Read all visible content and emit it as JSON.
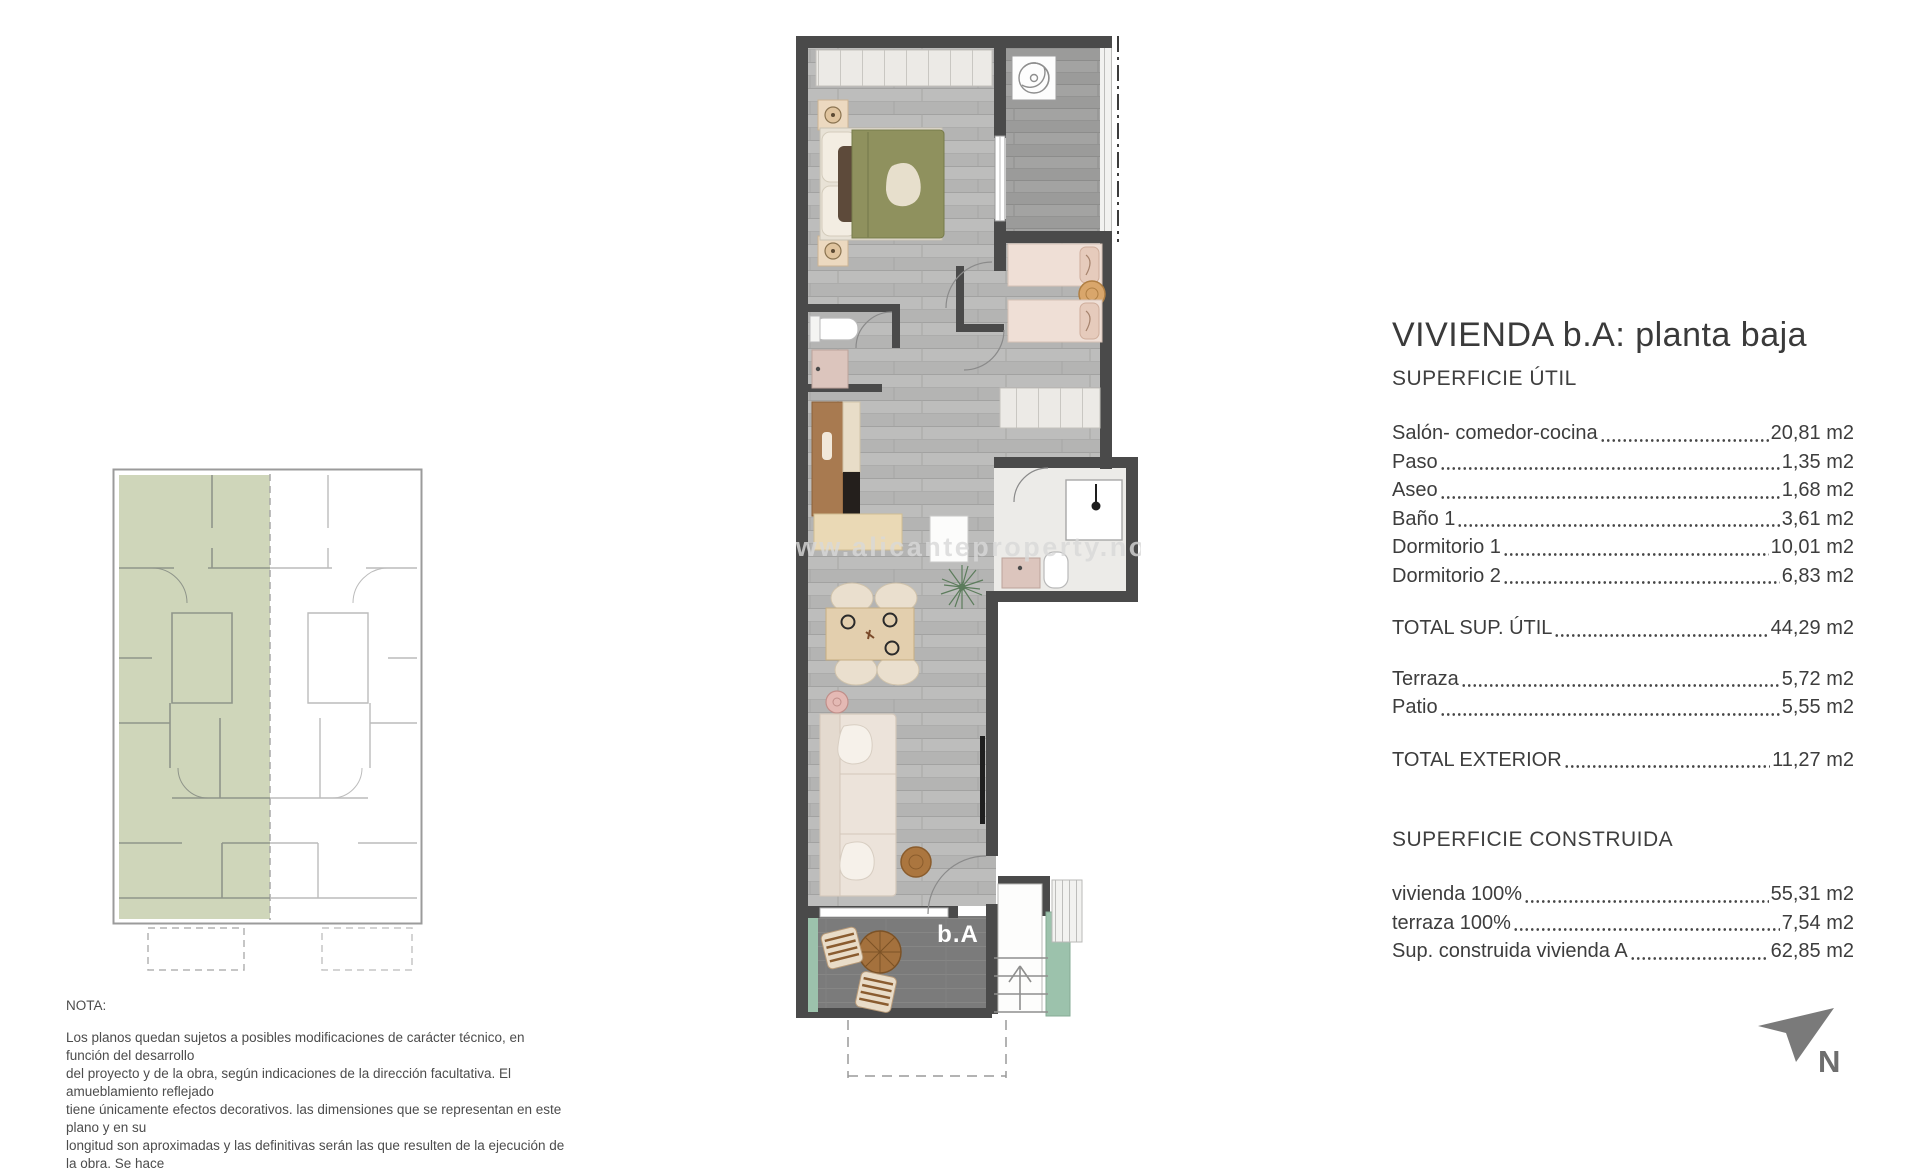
{
  "title": "VIVIENDA b.A: planta baja",
  "superficie_util": {
    "heading": "SUPERFICIE ÚTIL",
    "rows": [
      {
        "label": "Salón- comedor-cocina",
        "value": "20,81 m2"
      },
      {
        "label": "Paso",
        "value": "1,35 m2"
      },
      {
        "label": "Aseo",
        "value": "1,68 m2"
      },
      {
        "label": "Baño 1",
        "value": "3,61 m2"
      },
      {
        "label": "Dormitorio 1",
        "value": "10,01 m2"
      },
      {
        "label": "Dormitorio 2",
        "value": "6,83 m2"
      }
    ],
    "total": {
      "label": "TOTAL SUP. ÚTIL",
      "value": "44,29 m2"
    }
  },
  "exterior": {
    "rows": [
      {
        "label": "Terraza",
        "value": "5,72 m2"
      },
      {
        "label": "Patio",
        "value": "5,55 m2"
      }
    ],
    "total": {
      "label": "TOTAL EXTERIOR",
      "value": "11,27 m2"
    }
  },
  "construida": {
    "heading": "SUPERFICIE CONSTRUIDA",
    "rows": [
      {
        "label": "vivienda 100%",
        "value": "55,31 m2"
      },
      {
        "label": "terraza 100%",
        "value": "7,54 m2"
      },
      {
        "label": "Sup. construida vivienda A",
        "value": "62,85 m2"
      }
    ]
  },
  "nota": {
    "heading": "NOTA:",
    "lines": [
      {
        "text": "Los planos quedan sujetos a posibles modificaciones de carácter técnico, en función del desarrollo"
      },
      {
        "text": "del proyecto y de la obra, según indicaciones de la dirección facultativa. El amueblamiento reflejado"
      },
      {
        "text": "tiene únicamente efectos decorativos. las dimensiones que se representan en este plano y en su"
      },
      {
        "text": "longitud son aproximadas y las definitivas serán las que resulten de la ejecución de la obra. Se hace"
      }
    ]
  },
  "plan": {
    "unit_label": "b.A",
    "watermark": "www.alicanteproperty.no"
  },
  "north_label": "N",
  "colors": {
    "wall": "#4a4a4a",
    "interior_floor": "#b4b4b3",
    "patio_floor": "#9c9c9b",
    "terrace_floor": "#7b7b7b",
    "planter_green": "#9cc2ac",
    "key_plan_highlight": "#ccd4b6",
    "duvet_olive": "#8f915e",
    "bed_linen_pink": "#efdfd6",
    "kitchen_wood": "#a87a50",
    "counter_beige": "#ead9b5",
    "north_arrow_gray": "#7a7a7a"
  }
}
